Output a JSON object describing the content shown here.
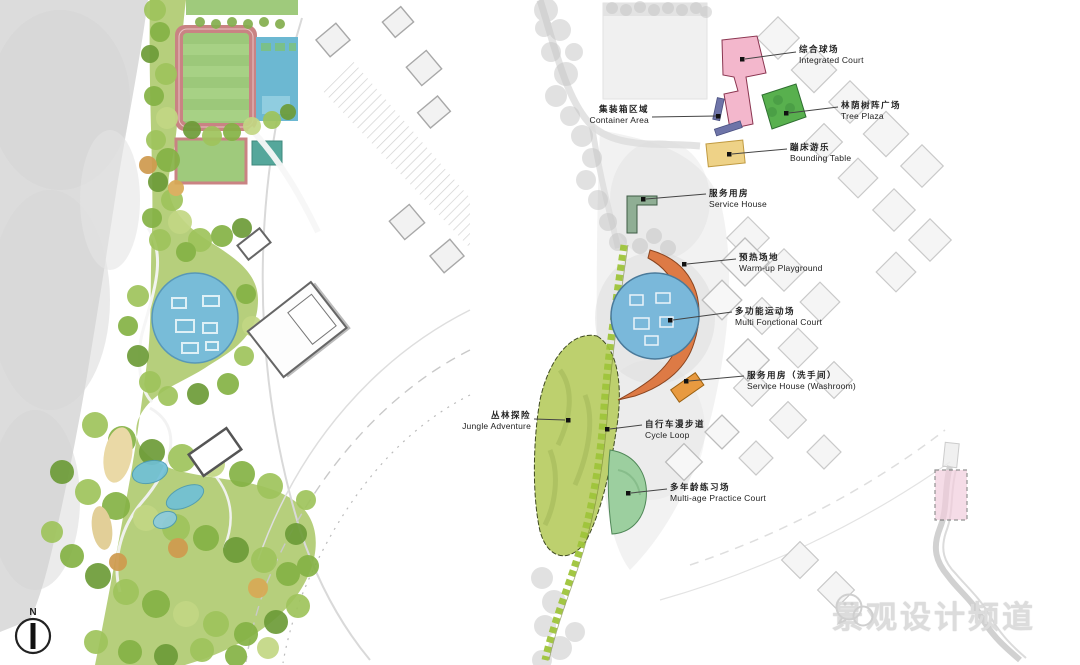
{
  "left_plan": {
    "compass_label": "N"
  },
  "right_plan": {
    "dashed_area_color": "#f2cedd",
    "annotations": [
      {
        "id": "integrated-court",
        "zh": "综合球场",
        "en": "Integrated Court",
        "color": "#f3b7cc"
      },
      {
        "id": "tree-plaza",
        "zh": "林荫树阵广场",
        "en": "Tree Plaza",
        "color": "#58b04e"
      },
      {
        "id": "container-area",
        "zh": "集装箱区域",
        "en": "Container Area",
        "color": "#6e74a8"
      },
      {
        "id": "bounding-table",
        "zh": "蹦床游乐",
        "en": "Bounding Table",
        "color": "#eed287"
      },
      {
        "id": "service-house",
        "zh": "服务用房",
        "en": "Service House",
        "color": "#8fae94"
      },
      {
        "id": "warm-up-playground",
        "zh": "预热场地",
        "en": "Warm-up Playground",
        "color": "#dd7a45"
      },
      {
        "id": "multi-functional-court",
        "zh": "多功能运动场",
        "en": "Multi Fonctional Court",
        "color": "#7ab8da"
      },
      {
        "id": "service-house-washroom",
        "zh": "服务用房（洗手间）",
        "en": "Service House (Washroom)",
        "color": "#e89a40"
      },
      {
        "id": "jungle-adventure",
        "zh": "丛林探险",
        "en": "Jungle Adventure",
        "color": "#bdd06e"
      },
      {
        "id": "cycle-loop",
        "zh": "自行车漫步道",
        "en": "Cycle Loop",
        "color": "#9ec43a"
      },
      {
        "id": "multi-age-practice-court",
        "zh": "多年龄练习场",
        "en": "Multi-age Practice Court",
        "color": "#9ccf9f"
      }
    ]
  },
  "watermark": {
    "text": "景观设计频道"
  }
}
